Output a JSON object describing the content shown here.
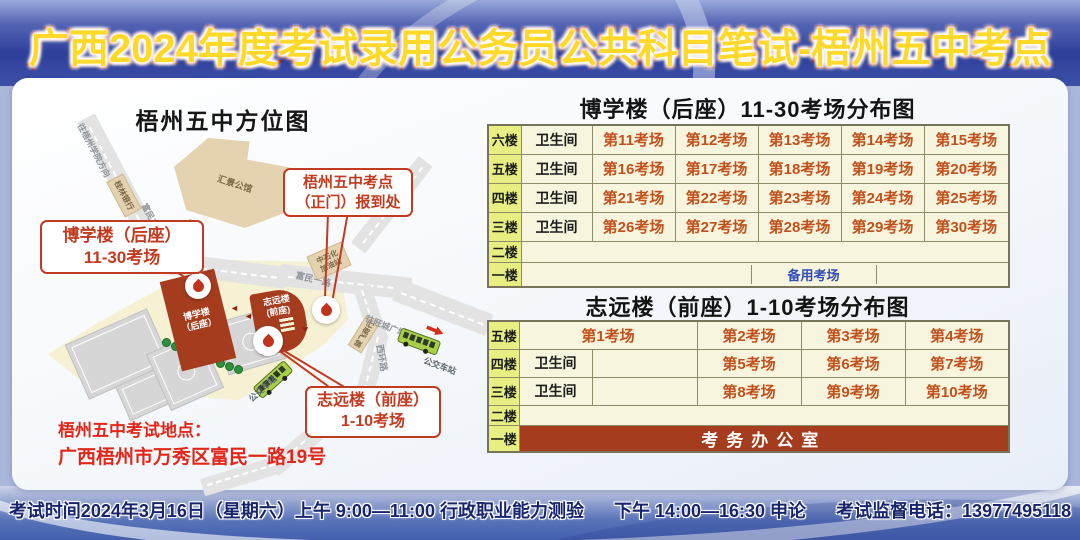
{
  "banner": {
    "title": "广西2024年度考试录用公务员公共科目笔试-梧州五中考点"
  },
  "map": {
    "title": "梧州五中方位图",
    "road_labels": {
      "to_university": "往梧州学院方向",
      "fumin_er_lu": "富民二路",
      "fumin_yi_lu": "富民一路",
      "to_wangcheng_plaza": "往旺城广场方向",
      "xihuan_lu": "西环路",
      "bus_stop_left": "公交车站",
      "bus_stop_right": "公交车站"
    },
    "pois": {
      "huijing_mansion": "汇景公馆",
      "guilin_bank": "桂林银行",
      "nanguo_hotel": "南国饭店",
      "sinopec_line1": "中石化",
      "sinopec_line2": "加油站",
      "junfei_shop": "骏飞商行"
    },
    "buildings": {
      "boxue_line1": "博学楼",
      "boxue_line2": "（后座）",
      "zhiyuan_line1": "志远楼",
      "zhiyuan_line2": "(前座)"
    },
    "callouts": {
      "boxue_line1": "博学楼（后座）",
      "boxue_line2": "11-30考场",
      "gate_line1": "梧州五中考点",
      "gate_line2": "（正门）报到处",
      "zhiyuan_line1": "志远楼（前座）",
      "zhiyuan_line2": "1-10考场"
    },
    "address_title": "梧州五中考试地点：",
    "address": "广西梧州市万秀区富民一路19号"
  },
  "tables": {
    "boxue": {
      "title": "博学楼（后座）11-30考场分布图",
      "floors": [
        "六楼",
        "五楼",
        "四楼",
        "三楼",
        "二楼",
        "一楼"
      ],
      "rows": [
        [
          "卫生间",
          "第11考场",
          "第12考场",
          "第13考场",
          "第14考场",
          "第15考场"
        ],
        [
          "卫生间",
          "第16考场",
          "第17考场",
          "第18考场",
          "第19考场",
          "第20考场"
        ],
        [
          "卫生间",
          "第21考场",
          "第22考场",
          "第23考场",
          "第24考场",
          "第25考场"
        ],
        [
          "卫生间",
          "第26考场",
          "第27考场",
          "第28考场",
          "第29考场",
          "第30考场"
        ]
      ],
      "floor1_special": "备用考场"
    },
    "zhiyuan": {
      "title": "志远楼（前座）1-10考场分布图",
      "floors": [
        "五楼",
        "四楼",
        "三楼",
        "二楼",
        "一楼"
      ],
      "row5": [
        "第1考场",
        "第2考场",
        "第3考场",
        "第4考场"
      ],
      "row4": [
        "卫生间",
        "第5考场",
        "第6考场",
        "第7考场"
      ],
      "row3": [
        "卫生间",
        "第8考场",
        "第9考场",
        "第10考场"
      ],
      "floor1_label": "考务办公室"
    }
  },
  "footer": {
    "schedule_morning": "考试时间2024年3月16日（星期六）上午 9:00—11:00 行政职业能力测验",
    "schedule_afternoon": "下午 14:00—16:30 申论",
    "phone": "考试监督电话：13977495118"
  },
  "colors": {
    "banner_title_fill": "#ffd92a",
    "banner_title_stroke": "#8e1408",
    "table_floor_bg": "#e7ef82",
    "table_cell_bg": "#f7f5dd",
    "exam_room_text": "#c0511d",
    "reserve_room_text": "#2f4db8",
    "brick_red": "#a63c1e",
    "callout_red": "#c23a20",
    "address_red": "#e2271a",
    "footer_text": "#18246b"
  }
}
